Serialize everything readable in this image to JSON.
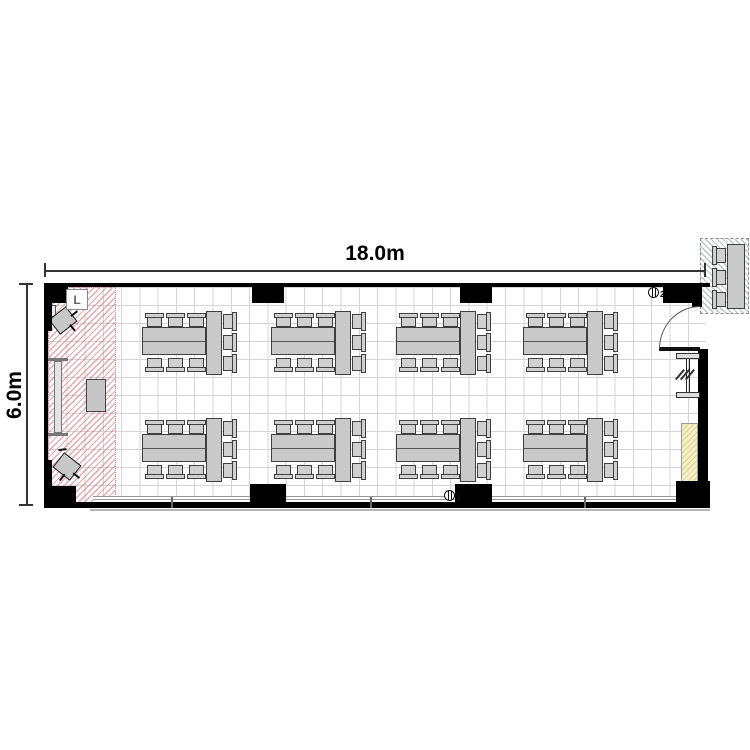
{
  "plan_title": "meeting-room-floor-plan",
  "dimensions": {
    "width_label": "18.0m",
    "height_label": "6.0m"
  },
  "symbols": {
    "light_label": "L",
    "outlet_label": "2"
  },
  "furniture_summary": {
    "table_groups": 8,
    "rows": 2,
    "columns": 4,
    "chairs_per_group": 9,
    "external_chairs": 3
  },
  "colors": {
    "wall": "#000000",
    "grid_line": "#d5d5d5",
    "furniture_fill": "#c9c9c9",
    "furniture_border": "#3f3f3f",
    "stage_hatch": "#cd6470",
    "yellow_area": "#f5efc6",
    "external_hatch": "#6c768c",
    "dimension": "#333333"
  },
  "geometry": {
    "floor": [
      48,
      287,
      658,
      216
    ],
    "stage": [
      48,
      287,
      68,
      216
    ],
    "walls": [
      [
        44,
        283,
        666,
        4
      ],
      [
        44,
        283,
        4,
        224
      ],
      [
        44,
        502,
        666,
        6
      ],
      [
        698,
        349,
        10,
        158
      ],
      [
        692,
        287,
        10,
        20
      ],
      [
        663,
        283,
        37,
        20
      ],
      [
        44,
        283,
        24,
        20
      ],
      [
        44,
        283,
        8,
        48
      ],
      [
        252,
        283,
        32,
        20
      ],
      [
        460,
        283,
        32,
        20
      ],
      [
        44,
        486,
        32,
        21
      ],
      [
        44,
        460,
        8,
        47
      ],
      [
        250,
        484,
        36,
        23
      ],
      [
        455,
        484,
        37,
        23
      ],
      [
        676,
        481,
        34,
        26
      ]
    ],
    "bottom_windows": [
      [
        93,
        496,
        157
      ],
      [
        286,
        496,
        169
      ],
      [
        492,
        496,
        184
      ]
    ],
    "window_ticks": [
      171,
      370,
      584
    ],
    "ground_line": [
      90,
      509,
      620,
      2
    ],
    "door": {
      "leaf": [
        659,
        347,
        41,
        4
      ],
      "arc": [
        659,
        306,
        41,
        43
      ]
    },
    "right_window": {
      "bars": [
        [
          676,
          353,
          24,
          6
        ],
        [
          676,
          392,
          24,
          6
        ]
      ],
      "post": [
        686,
        359,
        4,
        33
      ],
      "slashes_x": [
        679,
        684,
        689
      ],
      "slash_y": 368
    },
    "yellow_area": [
      681,
      423,
      17,
      65
    ],
    "whiteboard": {
      "caps": [
        [
          46,
          358,
          22,
          3
        ],
        [
          46,
          433,
          22,
          3
        ]
      ],
      "body": [
        54,
        361,
        8,
        72
      ]
    },
    "podium": [
      86,
      379,
      20,
      33
    ],
    "light_box": [
      66,
      289,
      22,
      21
    ],
    "wall_box": [
      45,
      305,
      11,
      12
    ],
    "speakers": [
      {
        "x": 52,
        "y": 311,
        "w": 22,
        "h": 19,
        "rot": -38
      },
      {
        "x": 56,
        "y": 457,
        "w": 22,
        "h": 19,
        "rot": 38
      }
    ],
    "outlets": [
      {
        "x": 648,
        "y": 287
      },
      {
        "x": 444,
        "y": 490
      }
    ],
    "table_groups": {
      "cols_x": [
        142,
        271,
        396,
        523
      ],
      "rows_y": [
        311,
        418
      ],
      "htable": [
        0,
        16,
        64,
        28
      ],
      "vtable": [
        64,
        0,
        16,
        64
      ],
      "chair_cols": [
        3,
        24,
        45
      ],
      "top_chair_y": 2,
      "bottom_chair_y": 47,
      "right_chair_x": 81,
      "right_chair_rows": [
        1,
        22,
        43
      ]
    },
    "external_unit": {
      "box": [
        700,
        238,
        49,
        76
      ],
      "table": [
        727,
        244,
        18,
        65
      ],
      "chairs_x": 712,
      "chairs_y": [
        246,
        268,
        290
      ]
    },
    "dim_top": {
      "line": [
        44,
        270,
        662,
        1.5
      ],
      "ticks": [
        [
          44,
          263,
          1.5,
          14
        ],
        [
          704,
          263,
          1.5,
          14
        ]
      ]
    },
    "dim_left": {
      "line": [
        26,
        284,
        1.5,
        222
      ],
      "ticks": [
        [
          19,
          283,
          14,
          1.5
        ],
        [
          19,
          504,
          14,
          1.5
        ]
      ]
    }
  }
}
